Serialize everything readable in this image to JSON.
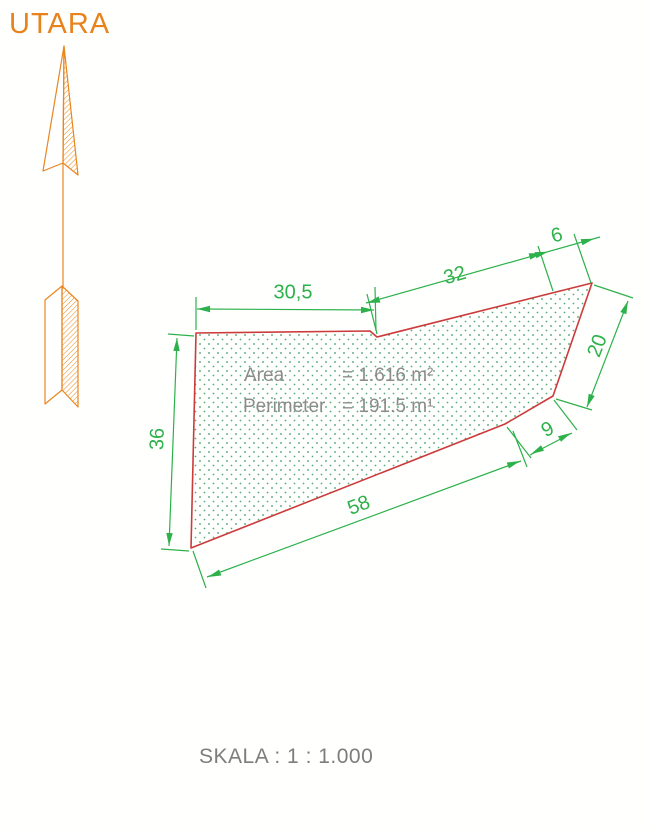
{
  "title": "Land parcel survey sketch",
  "colors": {
    "boundary_red": "#cc3b3b",
    "dimension_green": "#2db14b",
    "fill_dots_green": "#3b9e68",
    "north_orange": "#e8861f",
    "label_gray": "#8c8c8c",
    "scale_gray": "#7d7d7d"
  },
  "north_indicator": {
    "label": "UTARA",
    "icon": "north-arrow-icon"
  },
  "parcel": {
    "area_label": "Area",
    "area_value": "= 1.616 m²",
    "perimeter_label": "Perimeter",
    "perimeter_value": "= 191.5 m¹",
    "dimensions": [
      {
        "edge": "top-left",
        "value": "30,5"
      },
      {
        "edge": "top-middle",
        "value": "32"
      },
      {
        "edge": "top-corner",
        "value": "6"
      },
      {
        "edge": "right",
        "value": "20"
      },
      {
        "edge": "lower-right",
        "value": "9"
      },
      {
        "edge": "bottom",
        "value": "58"
      },
      {
        "edge": "left",
        "value": "36"
      }
    ]
  },
  "footer": {
    "scale_label": "SKALA : 1 : 1.000"
  }
}
